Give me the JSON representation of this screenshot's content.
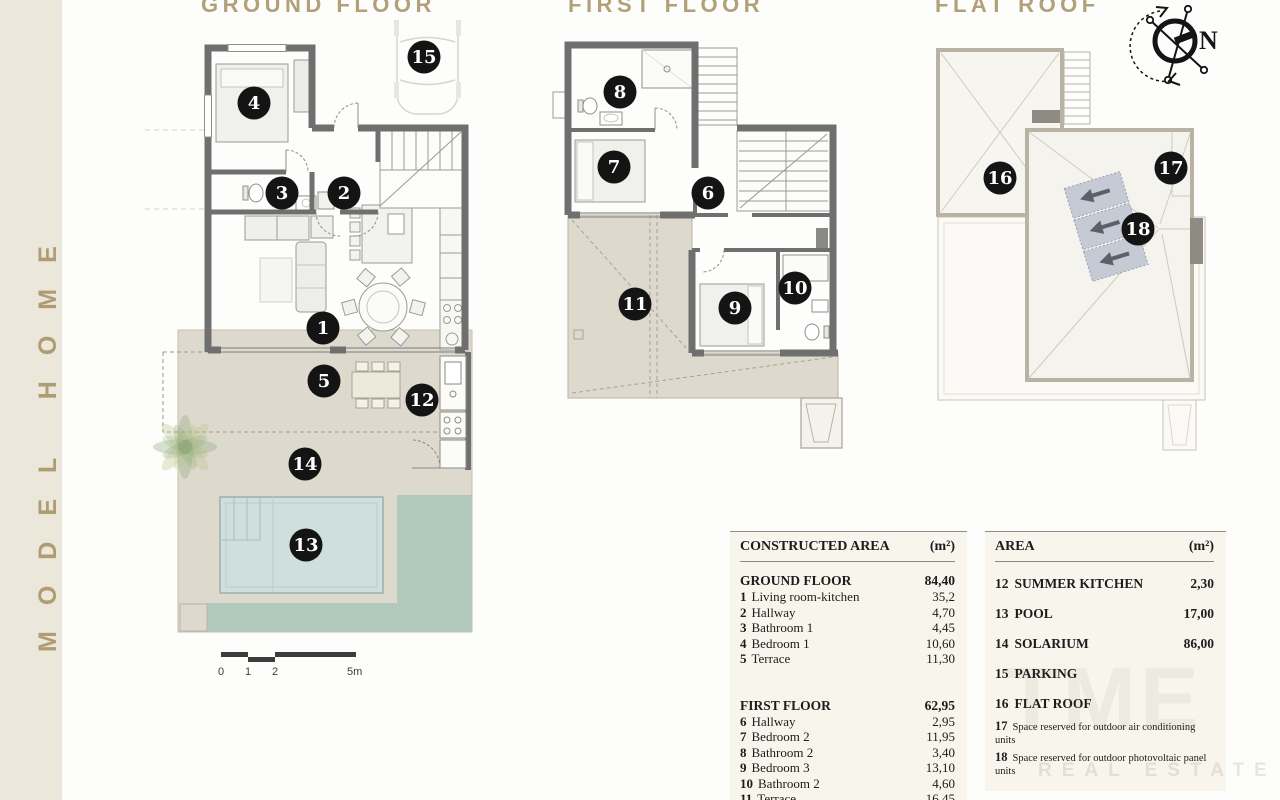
{
  "sidebar": {
    "label": "MODEL HOME"
  },
  "titles": {
    "ground": "GROUND FLOOR",
    "first": "FIRST FLOOR",
    "roof": "FLAT ROOF"
  },
  "compass": {
    "north_label": "N"
  },
  "scale_bar": {
    "ticks": [
      "0",
      "1",
      "2",
      "5m"
    ]
  },
  "markers": {
    "m1": "1",
    "m2": "2",
    "m3": "3",
    "m4": "4",
    "m5": "5",
    "m6": "6",
    "m7": "7",
    "m8": "8",
    "m9": "9",
    "m10": "10",
    "m11": "11",
    "m12": "12",
    "m13": "13",
    "m14": "14",
    "m15": "15",
    "m16": "16",
    "m17": "17",
    "m18": "18"
  },
  "colors": {
    "accent_gold": "#b1a078",
    "wall_gray": "#6f6f6f",
    "terrace_beige": "#ded9cd",
    "lawn_green": "#b1c9bb",
    "pool_blue": "#cfdfdc",
    "solar_panel": "#c6cad4",
    "table_bg": "#f8f5ed",
    "sidebar_bg": "#ebe7db",
    "marker_black": "#141414"
  },
  "tables": {
    "constructed": {
      "title": "CONSTRUCTED AREA",
      "unit": "(m²)",
      "groups": [
        {
          "name": "GROUND FLOOR",
          "value": "84,40",
          "rows": [
            {
              "num": "1",
              "name": "Living room-kitchen",
              "value": "35,2"
            },
            {
              "num": "2",
              "name": "Hallway",
              "value": "4,70"
            },
            {
              "num": "3",
              "name": "Bathroom 1",
              "value": "4,45"
            },
            {
              "num": "4",
              "name": "Bedroom 1",
              "value": "10,60"
            },
            {
              "num": "5",
              "name": "Terrace",
              "value": "11,30"
            }
          ]
        },
        {
          "name": "FIRST FLOOR",
          "value": "62,95",
          "rows": [
            {
              "num": "6",
              "name": "Hallway",
              "value": "2,95"
            },
            {
              "num": "7",
              "name": "Bedroom 2",
              "value": "11,95"
            },
            {
              "num": "8",
              "name": "Bathroom 2",
              "value": "3,40"
            },
            {
              "num": "9",
              "name": "Bedroom 3",
              "value": "13,10"
            },
            {
              "num": "10",
              "name": "Bathroom 2",
              "value": "4,60"
            },
            {
              "num": "11",
              "name": "Terrace",
              "value": "16,45"
            }
          ]
        }
      ]
    },
    "area": {
      "title": "AREA",
      "unit": "(m²)",
      "rows": [
        {
          "num": "12",
          "name": "SUMMER KITCHEN",
          "value": "2,30"
        },
        {
          "num": "13",
          "name": "POOL",
          "value": "17,00"
        },
        {
          "num": "14",
          "name": "SOLARIUM",
          "value": "86,00"
        },
        {
          "num": "15",
          "name": "PARKING",
          "value": ""
        },
        {
          "num": "16",
          "name": "FLAT ROOF",
          "value": ""
        }
      ],
      "notes": [
        {
          "num": "17",
          "text": "Space reserved for outdoor air conditioning units"
        },
        {
          "num": "18",
          "text": "Space reserved for outdoor photovoltaic panel units"
        }
      ]
    }
  },
  "watermark": {
    "brand": "TME",
    "subtitle": "REAL ESTATE"
  }
}
